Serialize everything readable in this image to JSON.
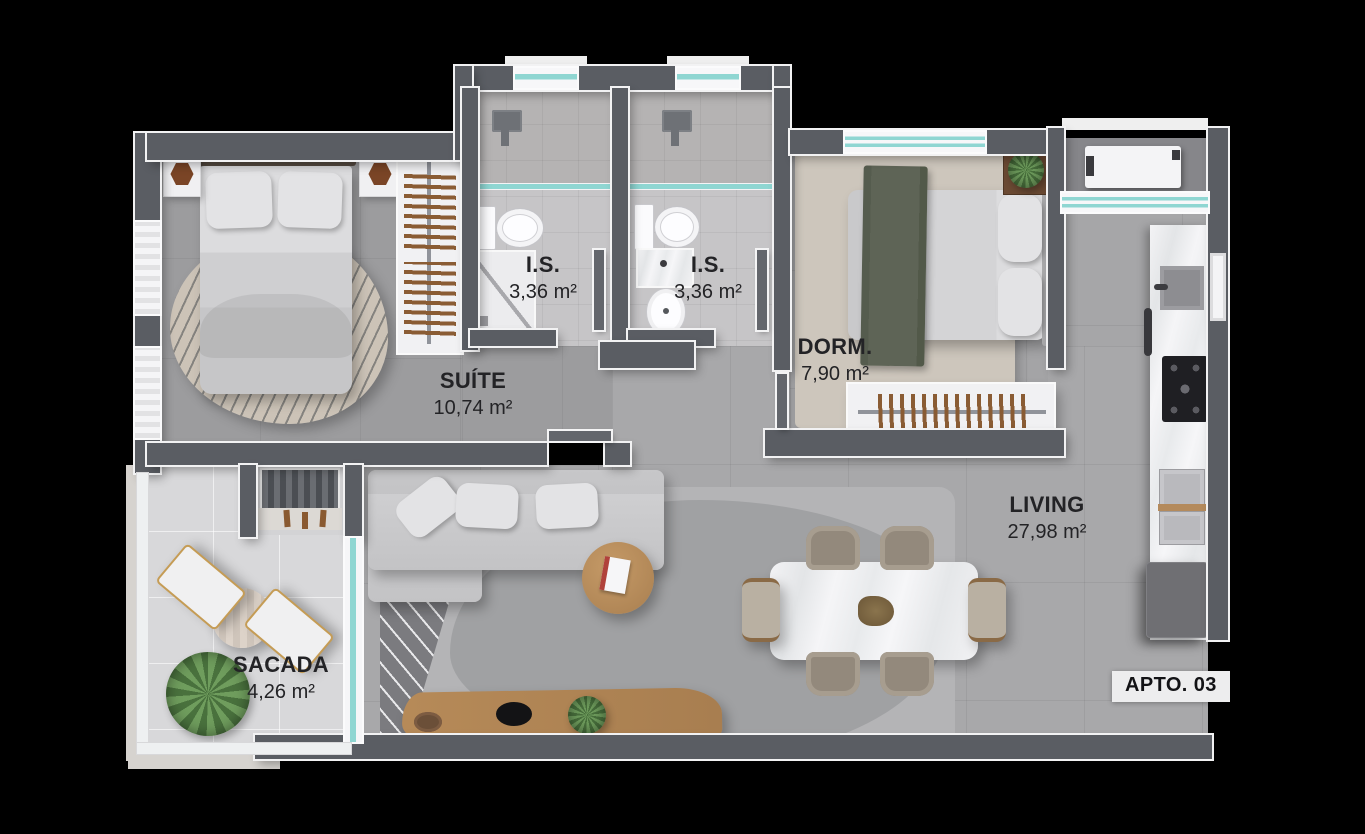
{
  "badge": {
    "label": "APTO. 03"
  },
  "rooms": {
    "suite": {
      "name": "SUÍTE",
      "area": "10,74 m²"
    },
    "is1": {
      "name": "I.S.",
      "area": "3,36 m²"
    },
    "is2": {
      "name": "I.S.",
      "area": "3,36 m²"
    },
    "dorm": {
      "name": "DORM.",
      "area": "7,90 m²"
    },
    "living": {
      "name": "LIVING",
      "area": "27,98 m²"
    },
    "sacada": {
      "name": "SACADA",
      "area": "4,26 m²"
    }
  },
  "colors": {
    "background": "#000000",
    "walls": "#5a5d63",
    "wall_outline": "#f2f2f3",
    "window_glass": "#8fd6d2",
    "floor_living": "#a8a8aa",
    "floor_suite": "#9c9c9e",
    "floor_bathroom": "#c6c5c7",
    "floor_balcony": "#d8d8da",
    "label_text": "#232326",
    "wood": "#b08a5e",
    "plant_green": "#6f9d5d",
    "blanket_green": "#5e6456"
  }
}
